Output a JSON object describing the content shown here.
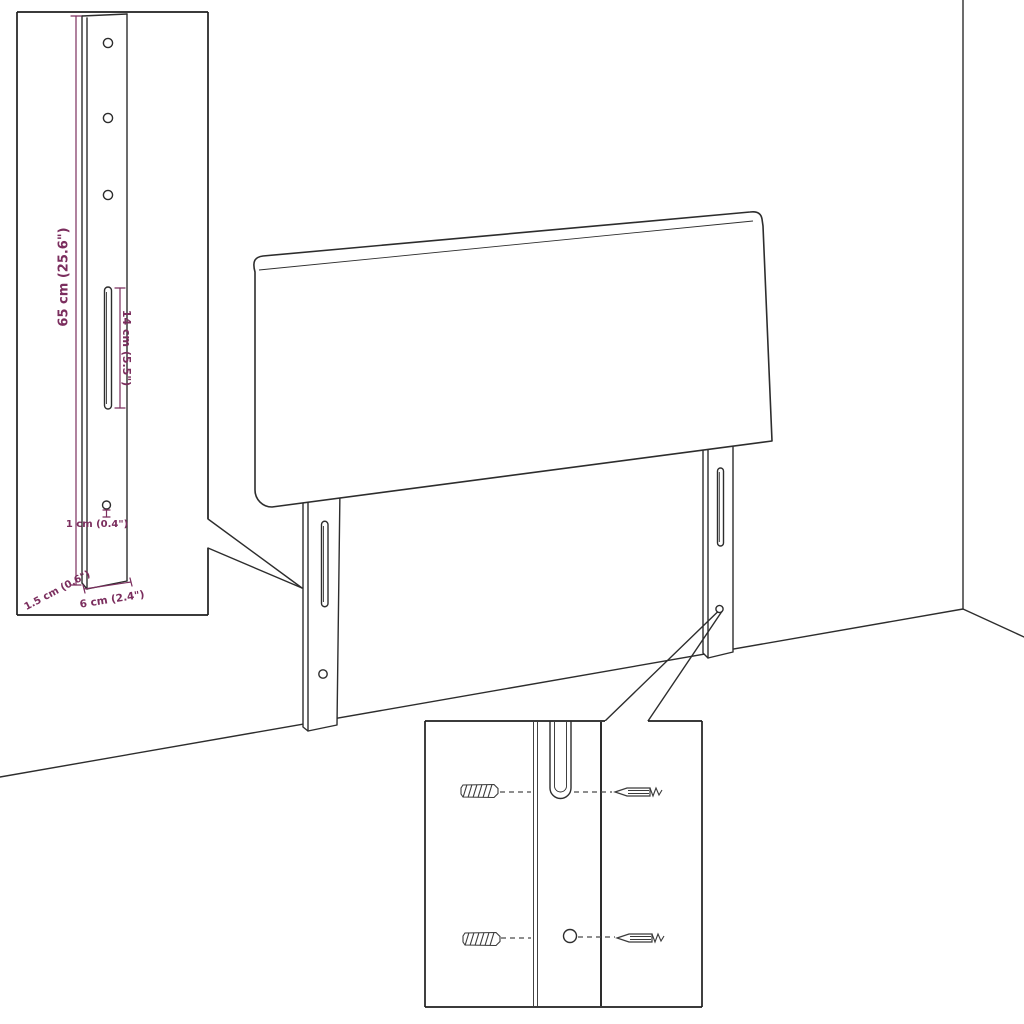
{
  "page": {
    "background": "#ffffff"
  },
  "diagram": {
    "accent_color": "#7b2e5e",
    "line_color": "#2d2d2d",
    "labels": {
      "bracket_height": "65 cm (25.6\")",
      "slot_length": "14 cm (5.5\")",
      "hole_diameter": "1 cm (0.4\")",
      "bracket_thickness": "1.5 cm (0.6\")",
      "bracket_width": "6 cm (2.4\")"
    }
  }
}
